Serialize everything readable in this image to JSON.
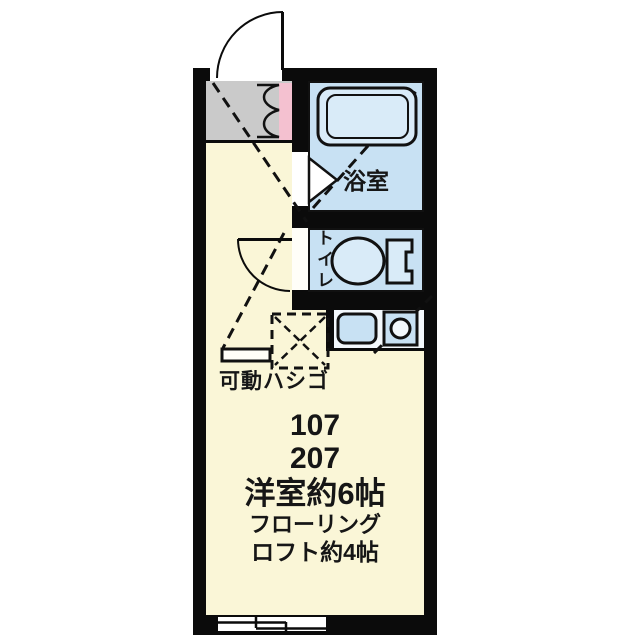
{
  "plan": {
    "type": "apartment-floor-plan",
    "rooms": {
      "bathroom": {
        "label": "浴室"
      },
      "toilet": {
        "label": "トイレ"
      },
      "main_room": {
        "unit_numbers": [
          "107",
          "207"
        ],
        "size_label": "洋室約6帖",
        "flooring_label": "フローリング",
        "loft_label": "ロフト約4帖"
      }
    },
    "ladder_label": "可動ハシゴ",
    "icons": [
      "entrance-door-arc",
      "shoe-cabinet",
      "bathtub",
      "folding-door",
      "toilet-bowl",
      "kitchen-sink",
      "stove-burner",
      "ladder-hatch",
      "interior-door-arc",
      "sliding-window",
      "loft-boundary-dashed-line"
    ],
    "colors": {
      "wall": "#0b0b0b",
      "main_room_fill": "#faf6d7",
      "wet_area_fill": "#c8e1f3",
      "fixture_fill": "#d9ebf8",
      "entrance_fill": "#cacaca",
      "accent_pink": "#f4c1d0",
      "background": "#ffffff"
    }
  }
}
